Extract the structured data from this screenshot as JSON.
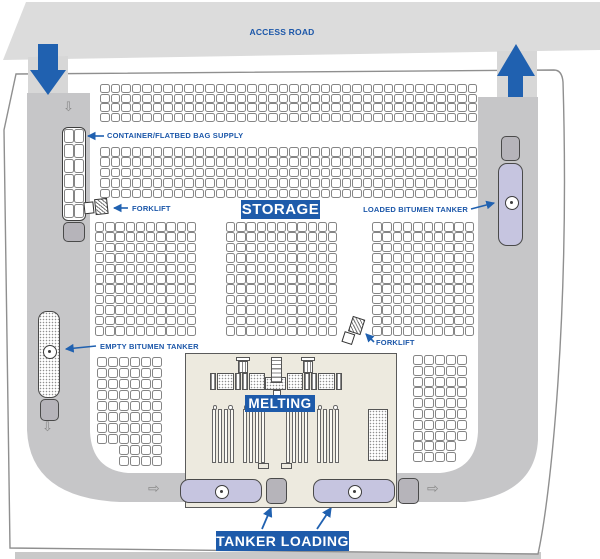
{
  "zones": {
    "access_road_label": "ACCESS ROAD",
    "storage_label": "STORAGE",
    "melting_label": "MELTING",
    "tanker_loading_label": "TANKER LOADING"
  },
  "annotations": {
    "container_supply": "CONTAINER/FLATBED BAG SUPPLY",
    "forklift_upper": "FORKLIFT",
    "forklift_lower": "FORKLIFT",
    "loaded_tanker": "LOADED BITUMEN TANKER",
    "empty_tanker": "EMPTY BITUMEN TANKER"
  },
  "traffic": {
    "entry_arrow_direction": "down",
    "exit_arrow_direction": "up",
    "down_glyph": "⇩",
    "right_glyph": "⇨"
  },
  "colors": {
    "accent_blue": "#1e5baa",
    "label_blue": "#1c57a9",
    "road_gray": "#c6c6c8",
    "band_gray": "#dcdcdc",
    "tanker_lavender": "#c6c5e0",
    "building_beige": "#edeadf"
  },
  "pallet_grids": [
    {
      "name": "bag-row-top",
      "x": 100,
      "y": 84,
      "cols": 36,
      "rows": 4,
      "cw": 10.5,
      "ch": 9.7
    },
    {
      "name": "bag-row-second",
      "x": 100,
      "y": 147,
      "cols": 36,
      "rows": 5,
      "cw": 10.5,
      "ch": 10.4
    },
    {
      "name": "storage-block-left",
      "x": 95,
      "y": 222,
      "cols": 10,
      "rows": 11,
      "cw": 10.2,
      "ch": 10.4
    },
    {
      "name": "storage-block-center",
      "x": 226,
      "y": 222,
      "cols": 11,
      "rows": 11,
      "cw": 10.2,
      "ch": 10.4
    },
    {
      "name": "storage-block-right",
      "x": 372,
      "y": 222,
      "cols": 10,
      "rows": 11,
      "cw": 10.3,
      "ch": 10.4
    },
    {
      "name": "lower-left-block",
      "x": 97,
      "y": 357,
      "cols": 6,
      "rows": 8,
      "cw": 11,
      "ch": 11
    },
    {
      "name": "lower-left-ext",
      "x": 119,
      "y": 445,
      "cols": 4,
      "rows": 2,
      "cw": 11,
      "ch": 11
    },
    {
      "name": "lower-right-block",
      "x": 413,
      "y": 355,
      "cols": 5,
      "rows": 8,
      "cw": 11,
      "ch": 10.8
    },
    {
      "name": "lower-right-ext",
      "x": 413,
      "y": 441.4,
      "cols": 4,
      "rows": 2,
      "cw": 11,
      "ch": 10.8
    }
  ],
  "container_grid": {
    "cols": 2,
    "rows": 6,
    "x": 63.5,
    "y": 129,
    "cw": 10.8,
    "ch": 15
  },
  "melting_plant": {
    "tank_group_count": 4,
    "bars_per_group": 4,
    "tank_groups_x": [
      26,
      57,
      100,
      131
    ],
    "tank_y": 55,
    "tank_h": 54
  }
}
